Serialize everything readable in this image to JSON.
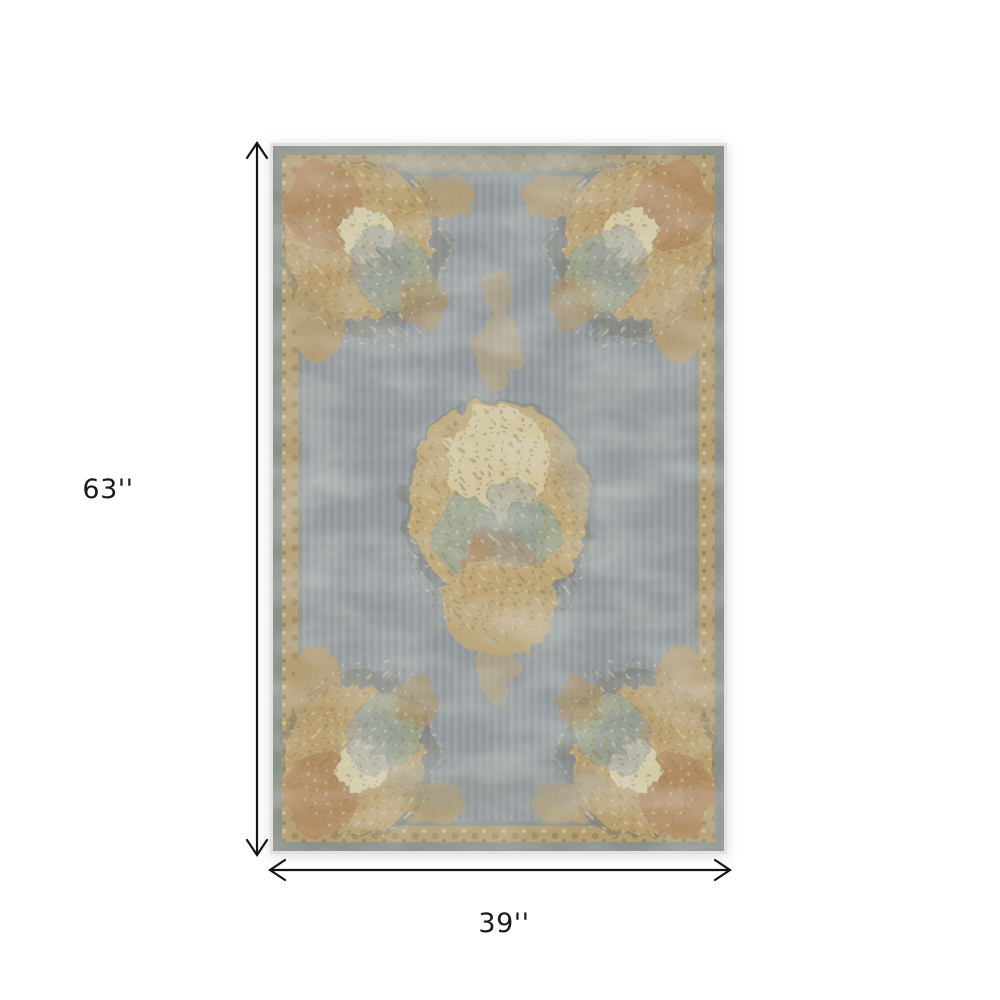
{
  "figure": {
    "type": "rug-product-dimension-diagram",
    "height_label": "63''",
    "width_label": "39''"
  },
  "colors": {
    "background": "#ffffff",
    "arrow": "#151515",
    "label_text": "#1b1b1b",
    "rug_edge_white": "#eceae6",
    "rug_border_graygreen": "#858c86",
    "rug_border_gold": "#b59c6c",
    "rug_field_gray": "#91989c",
    "rug_floral_tan": "#c2a771",
    "rug_floral_rust": "#b28759",
    "rug_floral_sage": "#9ba287",
    "rug_floral_cream": "#d7c99c"
  }
}
